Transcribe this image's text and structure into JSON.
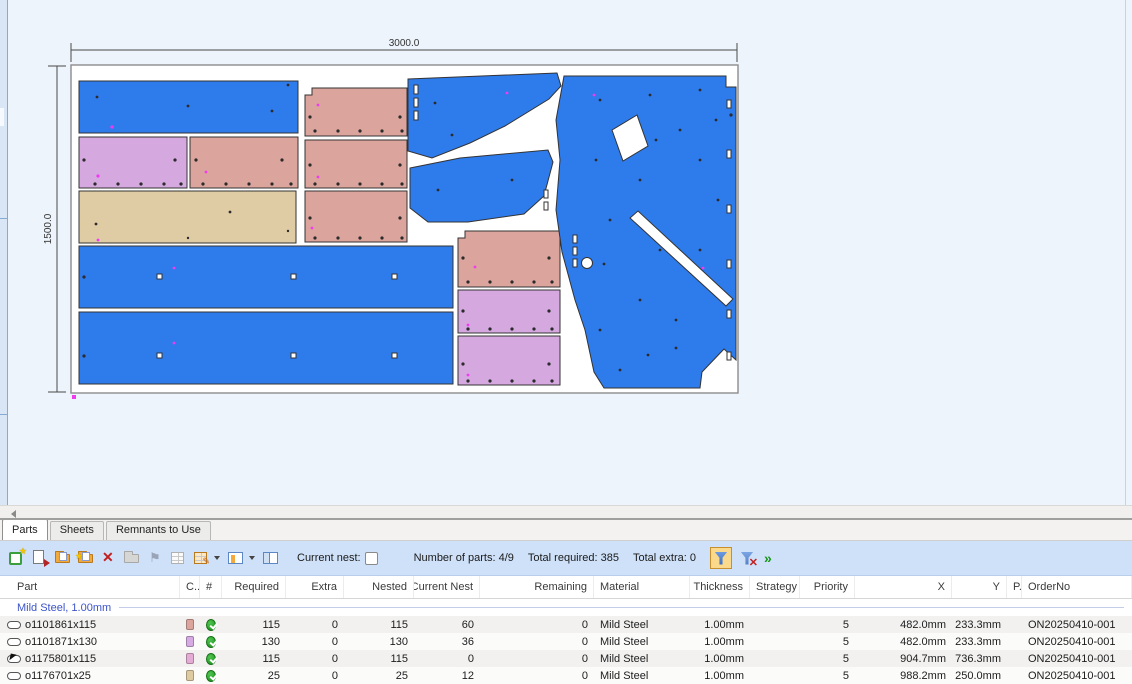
{
  "nest_view": {
    "dim_width_label": "3000.0",
    "dim_height_label": "1500.0",
    "part_colors": {
      "blue": "#2e7bec",
      "salmon": "#dba49c",
      "purple": "#d5a9e0",
      "tan": "#dfcca4"
    },
    "sheet_fill": "#ffffff",
    "canvas_bg": "#edf4fb"
  },
  "tabs": [
    {
      "label": "Parts",
      "active": true
    },
    {
      "label": "Sheets",
      "active": false
    },
    {
      "label": "Remnants to Use",
      "active": false
    }
  ],
  "toolbar": {
    "icons": [
      "new-part",
      "import-part",
      "open-folder",
      "copy-folder",
      "delete",
      "open-folder-disabled",
      "pin",
      "grid",
      "edit-columns",
      "view-options",
      "split-view"
    ],
    "current_nest_label": "Current nest:",
    "stats": {
      "parts": "Number of parts: 4/9",
      "required": "Total required: 385",
      "extra": "Total extra: 0"
    },
    "filter_icons": [
      "filter-on",
      "filter-clear",
      "more-chevrons"
    ]
  },
  "table": {
    "headers": [
      "Part",
      "C...",
      "#",
      "Required",
      "Extra",
      "Nested",
      "Current Nest",
      "Remaining",
      "Material",
      "Thickness",
      "Strategy",
      "Priority",
      "X",
      "Y",
      "P...",
      "OrderNo"
    ],
    "group_label": "Mild Steel, 1.00mm",
    "rows": [
      {
        "part": "o1101861x115",
        "c_color": "#dba49c",
        "required": "115",
        "extra": "0",
        "nested": "115",
        "current_nest": "60",
        "remaining": "0",
        "material": "Mild Steel",
        "thickness": "1.00mm",
        "strategy": "",
        "priority": "5",
        "x": "482.0mm",
        "y": "233.3mm",
        "p": "",
        "order_no": "ON20250410-001"
      },
      {
        "part": "o1101871x130",
        "c_color": "#d6abe3",
        "required": "130",
        "extra": "0",
        "nested": "130",
        "current_nest": "36",
        "remaining": "0",
        "material": "Mild Steel",
        "thickness": "1.00mm",
        "strategy": "",
        "priority": "5",
        "x": "482.0mm",
        "y": "233.3mm",
        "p": "",
        "order_no": "ON20250410-001"
      },
      {
        "part": "o1175801x115",
        "c_color": "#e4acd5",
        "required": "115",
        "extra": "0",
        "nested": "115",
        "current_nest": "0",
        "remaining": "0",
        "material": "Mild Steel",
        "thickness": "1.00mm",
        "strategy": "",
        "priority": "5",
        "x": "904.7mm",
        "y": "736.3mm",
        "p": "",
        "order_no": "ON20250410-001"
      },
      {
        "part": "o1176701x25",
        "c_color": "#decba2",
        "required": "25",
        "extra": "0",
        "nested": "25",
        "current_nest": "12",
        "remaining": "0",
        "material": "Mild Steel",
        "thickness": "1.00mm",
        "strategy": "",
        "priority": "5",
        "x": "988.2mm",
        "y": "250.0mm",
        "p": "",
        "order_no": "ON20250410-001"
      }
    ]
  }
}
